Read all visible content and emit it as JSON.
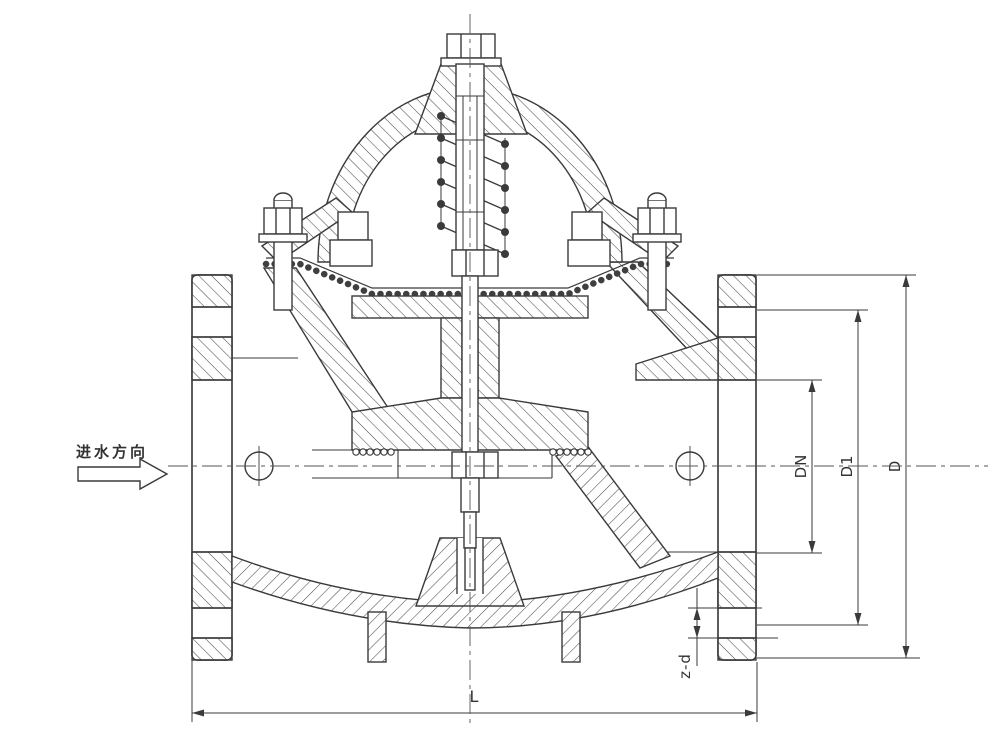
{
  "drawing": {
    "flow": {
      "label": "进水方向"
    },
    "dimensions": {
      "dn": {
        "label": "DN"
      },
      "d1": {
        "label": "D1"
      },
      "d": {
        "label": "D"
      },
      "zd": {
        "label": "z-d"
      },
      "l": {
        "label": "L"
      }
    },
    "colors": {
      "line": "#3a3a3a",
      "hatch": "#4d4d4d",
      "background": "#ffffff"
    }
  }
}
